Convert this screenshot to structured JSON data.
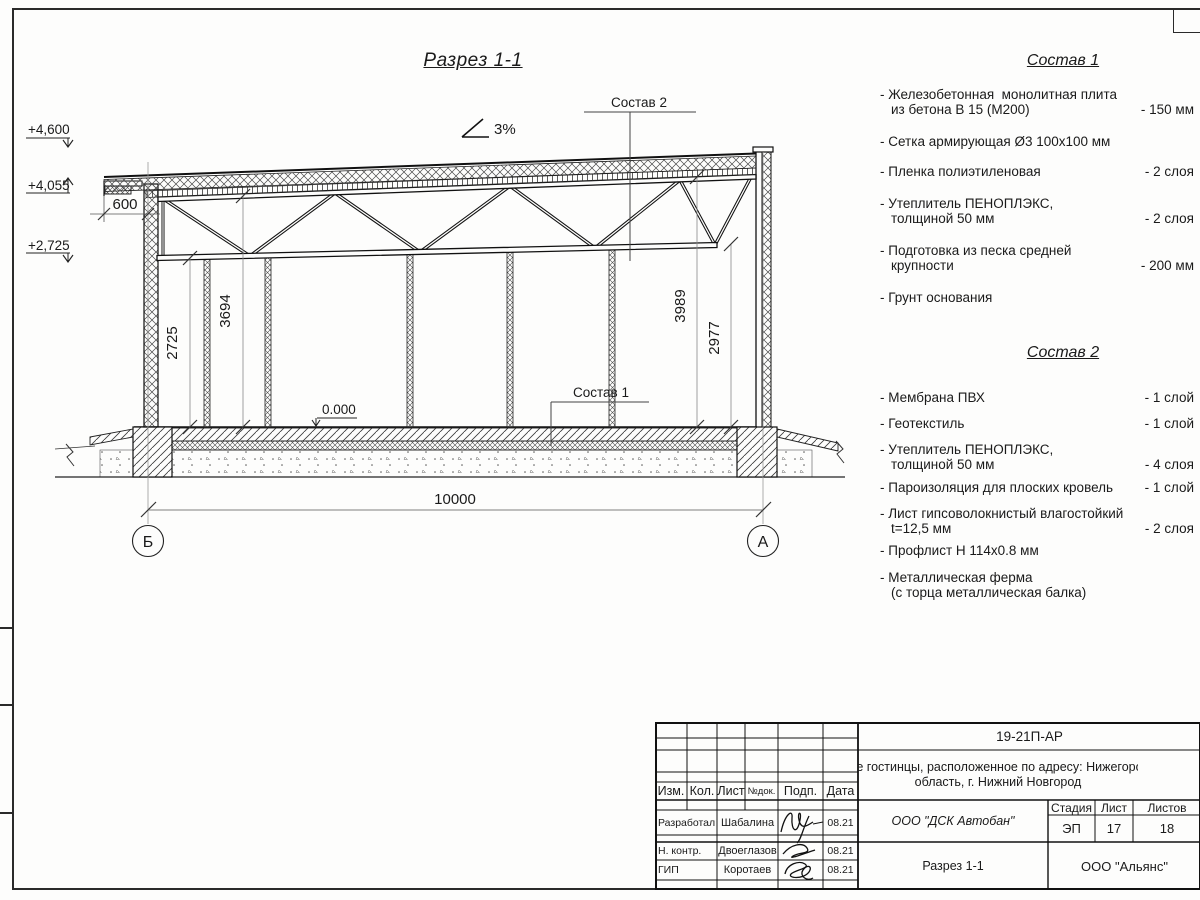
{
  "colors": {
    "ink": "#1a1a1a",
    "paper": "#fdfdfc",
    "faint": "#8a8a8a"
  },
  "sheet": {
    "drawing_title": "Разрез 1-1",
    "slope_label": "3%",
    "elevations": {
      "parapet_top": "+4,600",
      "eave": "+4,055",
      "truss_bottom": "+2,725",
      "floor": "0.000"
    },
    "dimensions": {
      "overhang": "600",
      "h_left_bottom": "2725",
      "h_left_top": "3694",
      "h_right_top": "3989",
      "h_right_bottom": "2977",
      "span": "10000"
    },
    "axes": {
      "left": "Б",
      "right": "А"
    },
    "callouts": {
      "roof": "Состав 2",
      "floor": "Состав 1"
    }
  },
  "compositions": [
    {
      "title": "Состав 1",
      "items": [
        {
          "name": "- Железобетонная  монолитная плита\nиз бетона В 15 (М200)",
          "value": "- 150 мм"
        },
        {
          "name": "- Сетка армирующая Ø3 100х100 мм",
          "value": ""
        },
        {
          "name": "- Пленка полиэтиленовая",
          "value": "- 2 слоя"
        },
        {
          "name": "- Утеплитель ПЕНОПЛЭКС,\nтолщиной 50 мм",
          "value": "- 2 слоя"
        },
        {
          "name": "- Подготовка из песка средней\nкрупности",
          "value": "- 200 мм"
        },
        {
          "name": "- Грунт основания",
          "value": ""
        }
      ]
    },
    {
      "title": "Состав 2",
      "items": [
        {
          "name": "- Мембрана ПВХ",
          "value": "- 1 слой"
        },
        {
          "name": "- Геотекстиль",
          "value": "- 1 слой"
        },
        {
          "name": "- Утеплитель ПЕНОПЛЭКС,\nтолщиной 50 мм",
          "value": "- 4 слоя"
        },
        {
          "name": "- Пароизоляция для плоских кровель",
          "value": "- 1 слой"
        },
        {
          "name": "- Лист гипсоволокнистый влагостойкий\nt=12,5 мм",
          "value": "- 2 слоя"
        },
        {
          "name": "- Профлист Н 114х0.8 мм",
          "value": ""
        },
        {
          "name": "- Металлическая ферма\n(с торца металлическая балка)",
          "value": ""
        }
      ]
    }
  ],
  "title_block": {
    "doc_number": "19-21П-АР",
    "project_name_line1": "Здание гостинцы, расположенное по адресу: Нижегородская",
    "project_name_line2": "область, г. Нижний Новгород",
    "columns": {
      "izm": "Изм.",
      "kol": "Кол.",
      "list": "Лист",
      "ndok": "№док.",
      "podp": "Подп.",
      "data": "Дата"
    },
    "rows": [
      {
        "role": "Разработал",
        "name": "Шабалина",
        "date": "08.21"
      },
      {
        "role": "Н. контр.",
        "name": "Двоеглазов",
        "date": "08.21"
      },
      {
        "role": "ГИП",
        "name": "Коротаев",
        "date": "08.21"
      }
    ],
    "stage_label": "Стадия",
    "sheet_label": "Лист",
    "sheets_label": "Листов",
    "stage": "ЭП",
    "sheet": "17",
    "sheets": "18",
    "contractor": "ООО \"ДСК Автобан\"",
    "view_name": "Разрез 1-1",
    "company": "ООО \"Альянс\""
  }
}
